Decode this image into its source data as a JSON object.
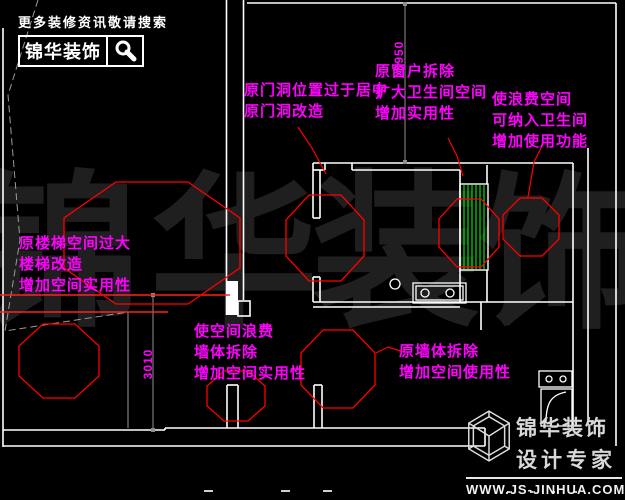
{
  "header": {
    "slogan": "更多装修资讯敬请搜索",
    "brand": "锦华装饰"
  },
  "watermark": {
    "char1": "锦",
    "char2": "华",
    "char3": "装",
    "char4": "饰"
  },
  "annotations": {
    "door": {
      "line1": "原门洞位置过于居中",
      "line2": "原门洞改造"
    },
    "window": {
      "line1": "原窗户拆除",
      "line2": "扩大卫生间空间",
      "line3": "增加实用性"
    },
    "waste_right": {
      "line1": "使浪费空间",
      "line2": "可纳入卫生间",
      "line3": "增加使用功能"
    },
    "stairs": {
      "line1": "原楼梯空间过大",
      "line2": "楼梯改造",
      "line3": "增加空间实用性"
    },
    "wall_center": {
      "line1": "使空间浪费",
      "line2": "墙体拆除",
      "line3": "增加空间实用性"
    },
    "wall_right": {
      "line1": "原墙体拆除",
      "line2": "增加空间使用性"
    }
  },
  "dimensions": {
    "vertical_top": "3950",
    "vertical_left": "3010"
  },
  "footer": {
    "brand": "锦华装饰",
    "tagline": "设计专家",
    "website": "WWW.JS-JINHUA.COM"
  },
  "colors": {
    "background": "#000000",
    "wall": "#ffffff",
    "dim_line": "#8f8f8f",
    "annotation": "#ff00ff",
    "revision": "#ff0000",
    "hatch": "#00e400",
    "watermark": "#1f1f1f"
  }
}
